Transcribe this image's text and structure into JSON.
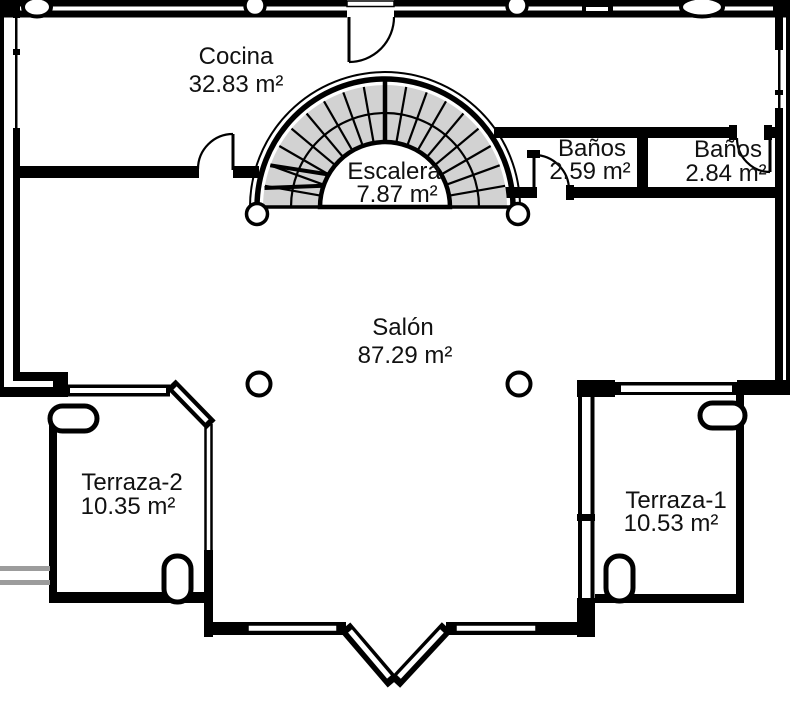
{
  "plan_title": "Planta - vivienda",
  "colors": {
    "wall": "#000000",
    "stair_fill": "#d2d2d2",
    "railing": "#9c9c9c",
    "background": "#ffffff",
    "text": "#111111"
  },
  "rooms": [
    {
      "id": "cocina",
      "name": "Cocina",
      "area": "32.83 m²"
    },
    {
      "id": "escalera",
      "name": "Escalera",
      "area": "7.87 m²"
    },
    {
      "id": "banos-1",
      "name": "Baños",
      "area": "2.59 m²"
    },
    {
      "id": "banos-2",
      "name": "Baños",
      "area": "2.84 m²"
    },
    {
      "id": "salon",
      "name": "Salón",
      "area": "87.29 m²"
    },
    {
      "id": "terraza-2",
      "name": "Terraza-2",
      "area": "10.35 m²"
    },
    {
      "id": "terraza-1",
      "name": "Terraza-1",
      "area": "10.53 m²"
    }
  ]
}
